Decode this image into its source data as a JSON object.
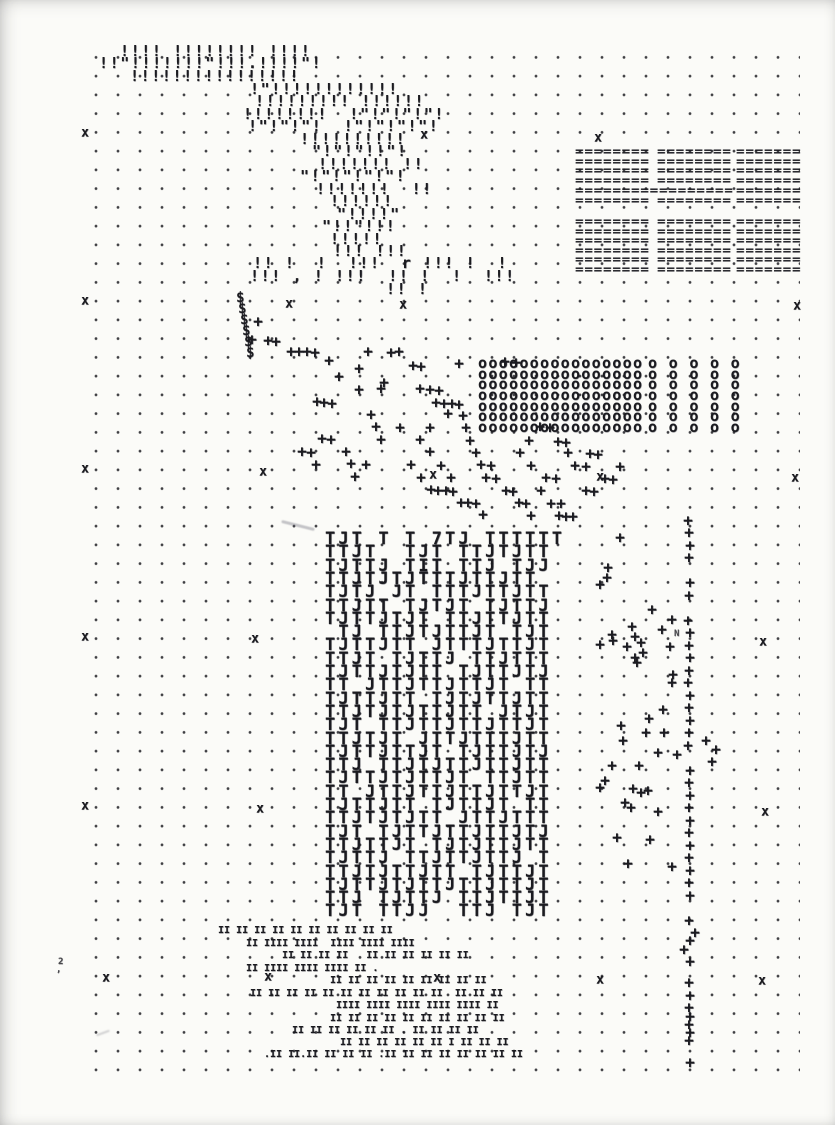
{
  "colors": {
    "ink": "#1b1b20",
    "paper": "#fbfbf8",
    "dot": "#26262b"
  },
  "dot_grid": {
    "x": 78,
    "y": 41,
    "width": 722,
    "height": 1044,
    "dx": 22,
    "dy": 18.75,
    "dot_radius": 1.1
  },
  "print": {
    "quote_lines": [
      {
        "x": 120,
        "y": 44,
        "t": "!!!! !!!!!!!! !!!!"
      },
      {
        "x": 99,
        "y": 56,
        "t": "!!\"!!!!!!!\"!!!.!!!!\"!"
      },
      {
        "x": 130,
        "y": 69,
        "t": "!!!!!!!!!!!!!!!!"
      },
      {
        "x": 250,
        "y": 82,
        "t": "!\"!!!!!!!!!!!!"
      },
      {
        "x": 255,
        "y": 94,
        "t": "!!!!!!!!! !!!!!!"
      },
      {
        "x": 243,
        "y": 107,
        "t": "!!!!!!!!  !\"!\"!\"!\"!"
      },
      {
        "x": 248,
        "y": 119,
        "t": "!\"!\"!\"!  !\"!\"!\"!\"!"
      },
      {
        "x": 300,
        "y": 132,
        "t": "!!!!!!!!!!"
      },
      {
        "x": 312,
        "y": 144,
        "t": "\"!\"!\"!!\"!"
      },
      {
        "x": 318,
        "y": 157,
        "t": "!!!!!!! !!"
      },
      {
        "x": 300,
        "y": 169,
        "t": "\"!\"!\"!\"!\"!"
      },
      {
        "x": 316,
        "y": 182,
        "t": "!!!!!!!  !!"
      },
      {
        "x": 330,
        "y": 194,
        "t": "!!!!!!"
      },
      {
        "x": 337,
        "y": 207,
        "t": "\"!!!!\""
      },
      {
        "x": 322,
        "y": 219,
        "t": "\"!!\"!!!"
      },
      {
        "x": 330,
        "y": 232,
        "t": "!!!!!"
      },
      {
        "x": 333,
        "y": 244,
        "t": "!!! !!!"
      },
      {
        "x": 253,
        "y": 256,
        "t": "!! !  !  !!!  r !!! !  !"
      },
      {
        "x": 250,
        "y": 269,
        "t": "!!! , ! !!!  !! !  !  !!!"
      },
      {
        "x": 386,
        "y": 282,
        "t": "!! !"
      }
    ],
    "equals_lines": [
      {
        "x": 575,
        "y": 146,
        "t": "========"
      },
      {
        "x": 575,
        "y": 156,
        "t": "========"
      },
      {
        "x": 575,
        "y": 165,
        "t": "========"
      },
      {
        "x": 575,
        "y": 175,
        "t": "========"
      },
      {
        "x": 575,
        "y": 185,
        "t": "================="
      },
      {
        "x": 575,
        "y": 195,
        "t": "========"
      },
      {
        "x": 657,
        "y": 146,
        "t": "========"
      },
      {
        "x": 657,
        "y": 156,
        "t": "========"
      },
      {
        "x": 657,
        "y": 165,
        "t": "========"
      },
      {
        "x": 657,
        "y": 175,
        "t": "========"
      },
      {
        "x": 657,
        "y": 195,
        "t": "========"
      },
      {
        "x": 736,
        "y": 146,
        "t": "======="
      },
      {
        "x": 736,
        "y": 156,
        "t": "======="
      },
      {
        "x": 736,
        "y": 165,
        "t": "======="
      },
      {
        "x": 736,
        "y": 175,
        "t": "======="
      },
      {
        "x": 736,
        "y": 185,
        "t": "======="
      },
      {
        "x": 736,
        "y": 195,
        "t": "======="
      },
      {
        "x": 575,
        "y": 216,
        "t": "========"
      },
      {
        "x": 575,
        "y": 226,
        "t": "========"
      },
      {
        "x": 575,
        "y": 235,
        "t": "========"
      },
      {
        "x": 575,
        "y": 245,
        "t": "========"
      },
      {
        "x": 575,
        "y": 254,
        "t": "========"
      },
      {
        "x": 575,
        "y": 264,
        "t": "========"
      },
      {
        "x": 657,
        "y": 216,
        "t": "========"
      },
      {
        "x": 657,
        "y": 226,
        "t": "========"
      },
      {
        "x": 657,
        "y": 235,
        "t": "========"
      },
      {
        "x": 657,
        "y": 245,
        "t": "========"
      },
      {
        "x": 657,
        "y": 254,
        "t": "========"
      },
      {
        "x": 657,
        "y": 264,
        "t": "========"
      },
      {
        "x": 736,
        "y": 216,
        "t": "======="
      },
      {
        "x": 736,
        "y": 226,
        "t": "======="
      },
      {
        "x": 736,
        "y": 235,
        "t": "======="
      },
      {
        "x": 736,
        "y": 245,
        "t": "======="
      },
      {
        "x": 736,
        "y": 254,
        "t": "======="
      },
      {
        "x": 736,
        "y": 264,
        "t": "======="
      }
    ],
    "dollar_marks": [
      {
        "x": 236,
        "y": 291,
        "t": "$"
      },
      {
        "x": 238,
        "y": 302,
        "t": "$"
      },
      {
        "x": 240,
        "y": 313,
        "t": "$"
      },
      {
        "x": 242,
        "y": 324,
        "t": "$"
      },
      {
        "x": 244,
        "y": 335,
        "t": "$"
      },
      {
        "x": 246,
        "y": 346,
        "t": "$"
      }
    ],
    "circle_lines": [
      {
        "x": 478,
        "y": 356,
        "t": "oooooooooooooooo"
      },
      {
        "x": 478,
        "y": 367,
        "t": "oooooooooooooooo"
      },
      {
        "x": 478,
        "y": 377,
        "t": "oooooooooooooooo"
      },
      {
        "x": 478,
        "y": 388,
        "t": "oooooooooooooooo"
      },
      {
        "x": 478,
        "y": 399,
        "t": "oooooooooooooooo"
      },
      {
        "x": 478,
        "y": 409,
        "t": "oooooooooooooooo"
      },
      {
        "x": 478,
        "y": 420,
        "t": "oooooooooooooooo"
      },
      {
        "x": 648,
        "y": 356,
        "t": "o o o o o"
      },
      {
        "x": 648,
        "y": 367,
        "t": "o o o o o"
      },
      {
        "x": 648,
        "y": 377,
        "t": "o o o o o"
      },
      {
        "x": 648,
        "y": 388,
        "t": "o o o o o"
      },
      {
        "x": 648,
        "y": 399,
        "t": "o o o o o"
      },
      {
        "x": 648,
        "y": 409,
        "t": "o o o o o"
      },
      {
        "x": 648,
        "y": 420,
        "t": "o o o o o"
      }
    ],
    "t_block": {
      "x": 325,
      "y": 531,
      "dy": 13.3,
      "rows": [
        "TJT T T 7TJ TTTTTT",
        "TTJT  TJT TTJTJTT",
        "TJTTJ TIT TTJ TJJ",
        "TTJTJTJTTTJTTJTT ",
        "TJTJ JT TTTJTTJTT",
        "TTJTT TJTJT TJTTJ",
        "TJTTJTJT TTJTTJTT",
        " TJ TTJTJTTJT TJT",
        "TJTTJTT JTTTJTTJT",
        "TTJT TJTTJ TTJTTT",
        "TJTTJTJTT TJTTJTJ",
        "TT JTTJTTJTTJT TT",
        "TJTTJTT TJTJTTJTT",
        "TTJTJTJTTJTT JTJT",
        "TJT TTJTTJTTJTTJT",
        "TTJTJT JTTJTTTJTT",
        "TJTTJTTJT TJTTJTJ",
        "TTJ TTJTJTTJTTJTT",
        "TJTTJTJTTJT TTJTT",
        "TT JTTJTTJTTJTTJT",
        "TJTTJTT TJTTJT TT",
        "TTJTJTJTT JTTJTTT",
        "TJT TJTTJTTJTTJTJ",
        "TTJTTJT TJTJTTJTT",
        "TJTTJ TTJTTJTTJ T",
        "TTJTJTTJTT TJTTJT",
        "TJTTJTJTTJTTJTTJT",
        "TTJ TJTTJ TTJTTJT",
        "TJT TTJJ  TTJ TJT"
      ]
    },
    "bar_lines": [
      {
        "x": 218,
        "y": 926,
        "t": "II II II II II II II II II II"
      },
      {
        "x": 246,
        "y": 939,
        "t": "II IIII IIII  IIII IIII IIII"
      },
      {
        "x": 282,
        "y": 951,
        "t": "II II II II   II II II II II II"
      },
      {
        "x": 246,
        "y": 964,
        "t": "II IIII IIII IIII II ."
      },
      {
        "x": 330,
        "y": 976,
        "t": "II II II II II II II II II"
      },
      {
        "x": 250,
        "y": 989,
        "t": "II II II II II II II II II II II  II II II"
      },
      {
        "x": 336,
        "y": 1001,
        "t": "IIII IIII IIII IIII IIII II"
      },
      {
        "x": 330,
        "y": 1014,
        "t": "II II II II II II II II II II"
      },
      {
        "x": 292,
        "y": 1026,
        "t": "II II II II II II . II II II II"
      },
      {
        "x": 340,
        "y": 1038,
        "t": "II II II II II II I II II II"
      },
      {
        "x": 264,
        "y": 1050,
        "t": ".II II.II II II II .II II II II II II II II"
      }
    ],
    "plus_points": [
      [
        258,
        322
      ],
      [
        252,
        340
      ],
      [
        268,
        341
      ],
      [
        276,
        342
      ],
      [
        291,
        352
      ],
      [
        299,
        352
      ],
      [
        307,
        352
      ],
      [
        315,
        353
      ],
      [
        329,
        361
      ],
      [
        368,
        352
      ],
      [
        391,
        353
      ],
      [
        399,
        352
      ],
      [
        413,
        366
      ],
      [
        421,
        367
      ],
      [
        459,
        364
      ],
      [
        505,
        362
      ],
      [
        516,
        363
      ],
      [
        359,
        369
      ],
      [
        339,
        377
      ],
      [
        384,
        383
      ],
      [
        381,
        389
      ],
      [
        359,
        390
      ],
      [
        420,
        389
      ],
      [
        430,
        390
      ],
      [
        439,
        391
      ],
      [
        317,
        402
      ],
      [
        324,
        403
      ],
      [
        332,
        404
      ],
      [
        436,
        403
      ],
      [
        444,
        404
      ],
      [
        452,
        404
      ],
      [
        459,
        405
      ],
      [
        371,
        415
      ],
      [
        448,
        414
      ],
      [
        463,
        416
      ],
      [
        376,
        427
      ],
      [
        400,
        428
      ],
      [
        430,
        428
      ],
      [
        466,
        428
      ],
      [
        540,
        427
      ],
      [
        550,
        428
      ],
      [
        322,
        439
      ],
      [
        331,
        440
      ],
      [
        381,
        440
      ],
      [
        420,
        440
      ],
      [
        470,
        441
      ],
      [
        529,
        441
      ],
      [
        558,
        442
      ],
      [
        566,
        443
      ],
      [
        302,
        452
      ],
      [
        311,
        453
      ],
      [
        346,
        452
      ],
      [
        430,
        452
      ],
      [
        476,
        453
      ],
      [
        520,
        453
      ],
      [
        568,
        453
      ],
      [
        590,
        454
      ],
      [
        598,
        455
      ],
      [
        316,
        465
      ],
      [
        351,
        464
      ],
      [
        366,
        465
      ],
      [
        411,
        465
      ],
      [
        441,
        466
      ],
      [
        481,
        465
      ],
      [
        491,
        466
      ],
      [
        531,
        466
      ],
      [
        575,
        466
      ],
      [
        586,
        467
      ],
      [
        620,
        467
      ],
      [
        355,
        477
      ],
      [
        421,
        478
      ],
      [
        451,
        478
      ],
      [
        486,
        478
      ],
      [
        496,
        479
      ],
      [
        546,
        478
      ],
      [
        556,
        479
      ],
      [
        605,
        479
      ],
      [
        613,
        480
      ],
      [
        431,
        490
      ],
      [
        438,
        491
      ],
      [
        446,
        491
      ],
      [
        453,
        492
      ],
      [
        506,
        491
      ],
      [
        513,
        492
      ],
      [
        541,
        491
      ],
      [
        586,
        491
      ],
      [
        594,
        492
      ],
      [
        461,
        503
      ],
      [
        468,
        503
      ],
      [
        476,
        504
      ],
      [
        519,
        503
      ],
      [
        526,
        504
      ],
      [
        551,
        504
      ],
      [
        561,
        504
      ],
      [
        483,
        515
      ],
      [
        531,
        516
      ],
      [
        559,
        516
      ],
      [
        566,
        517
      ],
      [
        573,
        517
      ],
      [
        688,
        521
      ],
      [
        689,
        533
      ],
      [
        690,
        546
      ],
      [
        689,
        558
      ],
      [
        690,
        583
      ],
      [
        689,
        596
      ],
      [
        688,
        621
      ],
      [
        690,
        633
      ],
      [
        689,
        646
      ],
      [
        690,
        658
      ],
      [
        689,
        671
      ],
      [
        688,
        683
      ],
      [
        690,
        696
      ],
      [
        689,
        708
      ],
      [
        690,
        721
      ],
      [
        689,
        733
      ],
      [
        688,
        746
      ],
      [
        690,
        771
      ],
      [
        689,
        783
      ],
      [
        690,
        796
      ],
      [
        689,
        808
      ],
      [
        690,
        821
      ],
      [
        689,
        833
      ],
      [
        690,
        846
      ],
      [
        689,
        858
      ],
      [
        690,
        871
      ],
      [
        689,
        883
      ],
      [
        690,
        896
      ],
      [
        689,
        921
      ],
      [
        695,
        933
      ],
      [
        690,
        941
      ],
      [
        684,
        950
      ],
      [
        690,
        962
      ],
      [
        689,
        983
      ],
      [
        690,
        996
      ],
      [
        689,
        1008
      ],
      [
        690,
        1017
      ],
      [
        689,
        1025
      ],
      [
        690,
        1033
      ],
      [
        689,
        1041
      ],
      [
        690,
        1063
      ],
      [
        620,
        538
      ],
      [
        608,
        568
      ],
      [
        607,
        578
      ],
      [
        600,
        585
      ],
      [
        652,
        610
      ],
      [
        672,
        620
      ],
      [
        662,
        630
      ],
      [
        632,
        627
      ],
      [
        612,
        635
      ],
      [
        635,
        637
      ],
      [
        613,
        641
      ],
      [
        600,
        645
      ],
      [
        627,
        647
      ],
      [
        641,
        643
      ],
      [
        643,
        653
      ],
      [
        670,
        647
      ],
      [
        635,
        658
      ],
      [
        637,
        663
      ],
      [
        673,
        675
      ],
      [
        672,
        683
      ],
      [
        663,
        710
      ],
      [
        649,
        719
      ],
      [
        621,
        726
      ],
      [
        646,
        733
      ],
      [
        664,
        733
      ],
      [
        623,
        741
      ],
      [
        658,
        753
      ],
      [
        677,
        755
      ],
      [
        612,
        766
      ],
      [
        639,
        766
      ],
      [
        605,
        781
      ],
      [
        600,
        788
      ],
      [
        633,
        789
      ],
      [
        641,
        793
      ],
      [
        648,
        791
      ],
      [
        625,
        803
      ],
      [
        631,
        808
      ],
      [
        658,
        812
      ],
      [
        706,
        741
      ],
      [
        716,
        750
      ],
      [
        712,
        762
      ],
      [
        617,
        838
      ],
      [
        650,
        840
      ],
      [
        628,
        864
      ],
      [
        672,
        867
      ]
    ],
    "registration_marks": [
      [
        85,
        133
      ],
      [
        424,
        135
      ],
      [
        598,
        138
      ],
      [
        85,
        301
      ],
      [
        289,
        304
      ],
      [
        403,
        305
      ],
      [
        797,
        306
      ],
      [
        85,
        469
      ],
      [
        263,
        472
      ],
      [
        433,
        475
      ],
      [
        600,
        477
      ],
      [
        795,
        478
      ],
      [
        85,
        637
      ],
      [
        255,
        639
      ],
      [
        763,
        642
      ],
      [
        85,
        806
      ],
      [
        260,
        809
      ],
      [
        765,
        812
      ],
      [
        106,
        978
      ],
      [
        268,
        977
      ],
      [
        437,
        978
      ],
      [
        600,
        980
      ],
      [
        762,
        981
      ]
    ],
    "stray_marks": [
      {
        "x": 58,
        "y": 958,
        "t": "2"
      },
      {
        "x": 674,
        "y": 630,
        "t": "N"
      },
      {
        "x": 56,
        "y": 966,
        "t": ","
      }
    ]
  }
}
